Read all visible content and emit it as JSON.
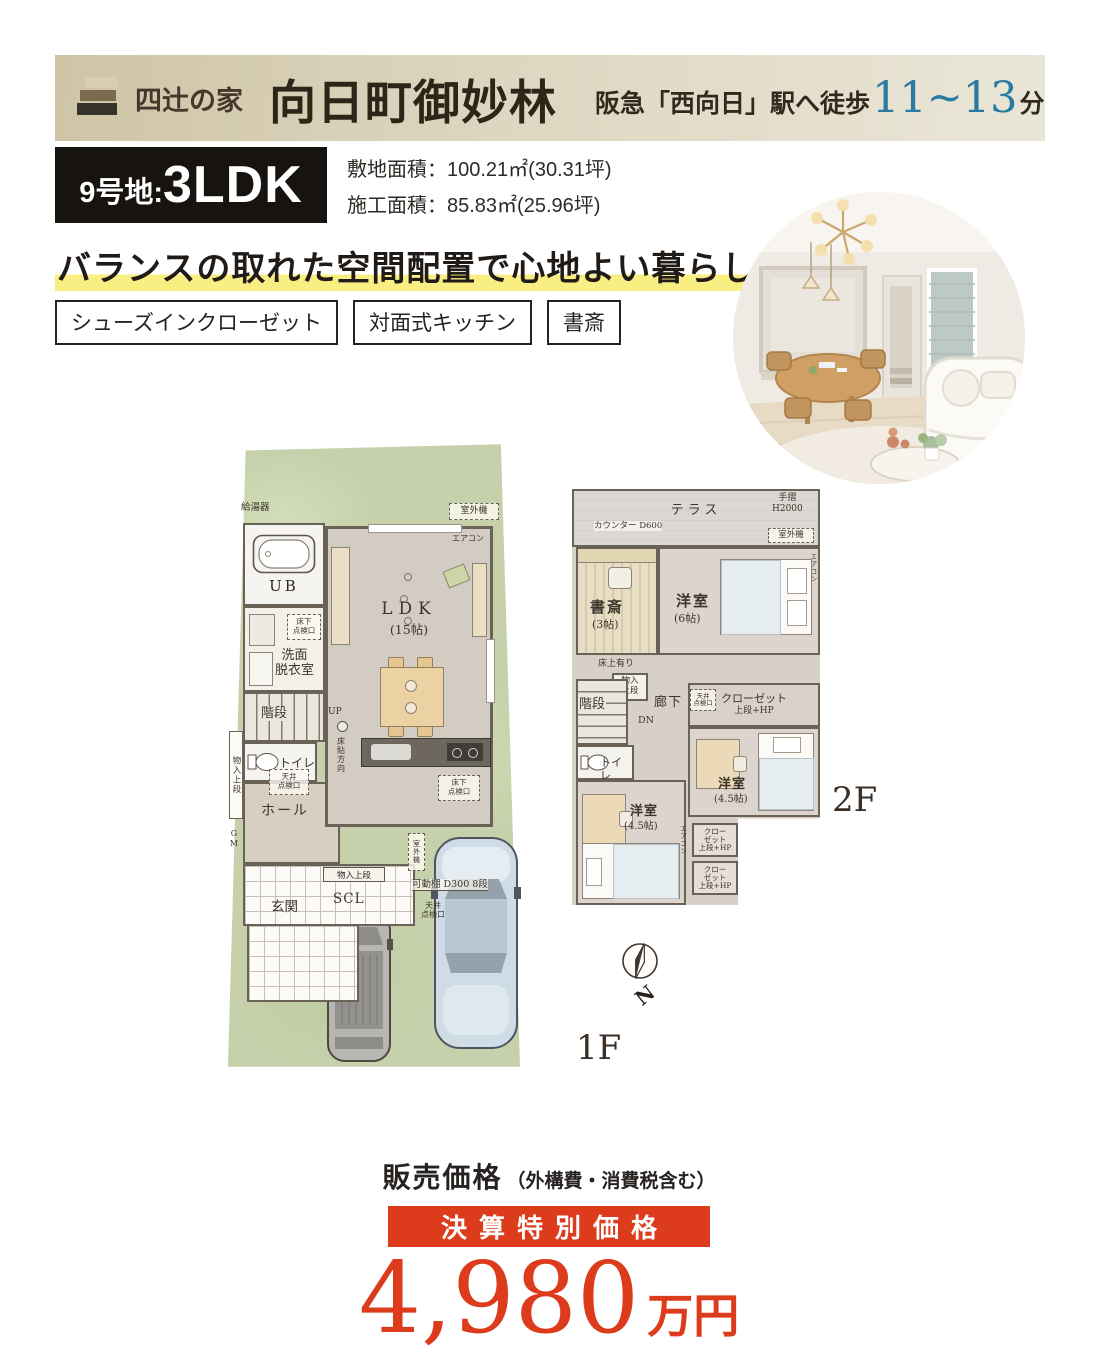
{
  "header": {
    "brand": "四辻の家",
    "title": "向日町御妙林",
    "access_prefix": "阪急「西向日」駅へ徒歩",
    "access_minutes": "11~13",
    "access_suffix": "分"
  },
  "unit": {
    "lot_label": "9号地:",
    "plan_type": "3LDK",
    "site_area": "敷地面積：100.21㎡(30.31坪)",
    "construction_area": "施工面積：85.83㎡(25.96坪)"
  },
  "headline": "バランスの取れた空間配置で心地よい暮らし",
  "features": [
    "シューズインクローゼット",
    "対面式キッチン",
    "書斎"
  ],
  "floor1": {
    "name": "1F",
    "labels": {
      "water_heater": "給湯器",
      "outdoor_unit": "室外機",
      "aircon": "エアコン",
      "bath": "UB",
      "underfloor_hatch": "床下\n点検口",
      "washroom": "洗面\n脱衣室",
      "stairs": "階段",
      "up": "UP",
      "toilet": "トイレ",
      "storage": "物入上段",
      "ceiling_hatch": "天井\n点検口",
      "hall": "ホール",
      "floor_direction": "床貼方向",
      "ldk": "LDK",
      "ldk_size": "(15帖)",
      "scl": "SCL",
      "entrance": "玄関",
      "side_unit": "室外機",
      "shelf": "可動棚 D300 8段",
      "gm": "GM"
    }
  },
  "floor2": {
    "name": "2F",
    "labels": {
      "terrace": "テラス",
      "counter": "カウンター D600",
      "handrail": "手摺\nH2000",
      "outdoor_unit": "室外機",
      "study": "書斎",
      "study_size": "(3帖)",
      "bedroom6": "洋室",
      "bedroom6_size": "(6帖)",
      "raised_floor": "床上有り",
      "storage": "物入\n上段",
      "stairs": "階段",
      "corridor": "廊下",
      "dn": "DN",
      "toilet": "トイレ",
      "closet": "クローゼット",
      "closet_sub": "上段+HP",
      "ceiling_hatch": "天井\n点検口",
      "bedroom45": "洋室",
      "bedroom45_size": "(4.5帖)",
      "closet_small": "クロー\nゼット\n上段+HP",
      "aircon": "エアコン"
    }
  },
  "compass": {
    "north": "N"
  },
  "price": {
    "label": "販売価格",
    "label_note": "（外構費・消費税含む）",
    "banner": "決算特別価格",
    "amount": "4,980",
    "amount_unit": "万円"
  },
  "colors": {
    "accent_red": "#dd3c1c",
    "highlight_yellow": "#f9ee82",
    "access_blue": "#2a7ba3",
    "lot_green": "#c6d1ab"
  }
}
